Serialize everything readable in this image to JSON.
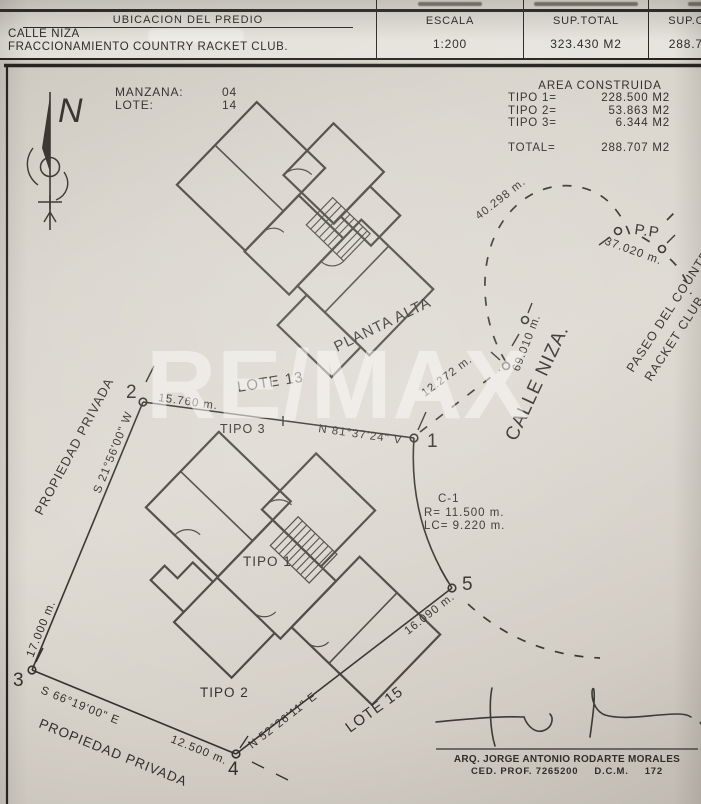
{
  "header": {
    "col_ubicacion": "UBICACION DEL PREDIO",
    "col_escala": "ESCALA",
    "col_sup_total": "SUP.TOTAL",
    "col_sup_const": "SUP.CONST.",
    "address_line1": "CALLE NIZA",
    "address_line2": "FRACCIONAMIENTO COUNTRY RACKET CLUB.",
    "escala": "1:200",
    "sup_total": "323.430 M2",
    "sup_const": "288.707 M2"
  },
  "info": {
    "manzana_label": "MANZANA:",
    "manzana_value": "04",
    "lote_label": "LOTE:",
    "lote_value": "14"
  },
  "area": {
    "title": "AREA CONSTRUIDA",
    "rows": [
      {
        "label": "TIPO 1=",
        "value": "228.500 M2"
      },
      {
        "label": "TIPO 2=",
        "value": "53.863 M2"
      },
      {
        "label": "TIPO 3=",
        "value": "6.344 M2"
      }
    ],
    "total_label": "TOTAL=",
    "total_value": "288.707 M2"
  },
  "labels": {
    "north": "N",
    "planta_alta": "PLANTA ALTA",
    "lote13": "LOTE 13",
    "lote15": "LOTE 15",
    "tipo1": "TIPO 1",
    "tipo2": "TIPO 2",
    "tipo3": "TIPO 3",
    "calle_niza": "CALLE NIZA.",
    "paseo_line1": "PASEO DEL COUNTRY",
    "paseo_line2": "RACKET CLUB.",
    "pp": "P.P",
    "propiedad_left": "PROPIEDAD PRIVADA",
    "propiedad_bottom": "PROPIEDAD PRIVADA"
  },
  "meas": {
    "m15760": "15.760 m.",
    "m17000": "17.000 m.",
    "m12500": "12.500 m.",
    "m16090": "16.090 m.",
    "m12272": "12.272 m.",
    "m69010": "69.010 m.",
    "m40298": "40.298 m.",
    "m37020": "37.020 m.",
    "b_n81": "N 81°37'24\" V",
    "b_s21": "S 21°56'00\" W",
    "b_s66": "S 66°19'00\" E",
    "b_n52": "N 52°26'11\" E"
  },
  "curve": {
    "name": "C-1",
    "radius": "R= 11.500 m.",
    "lc": "LC= 9.220 m."
  },
  "vertices": [
    "1",
    "2",
    "3",
    "4",
    "5"
  ],
  "watermark": "RE/MAX",
  "footer": {
    "architect": "ARQ. JORGE ANTONIO RODARTE MORALES",
    "cedula": "CED. PROF. 7265200",
    "dcm": "D.C.M.",
    "dcm_num": "172"
  }
}
